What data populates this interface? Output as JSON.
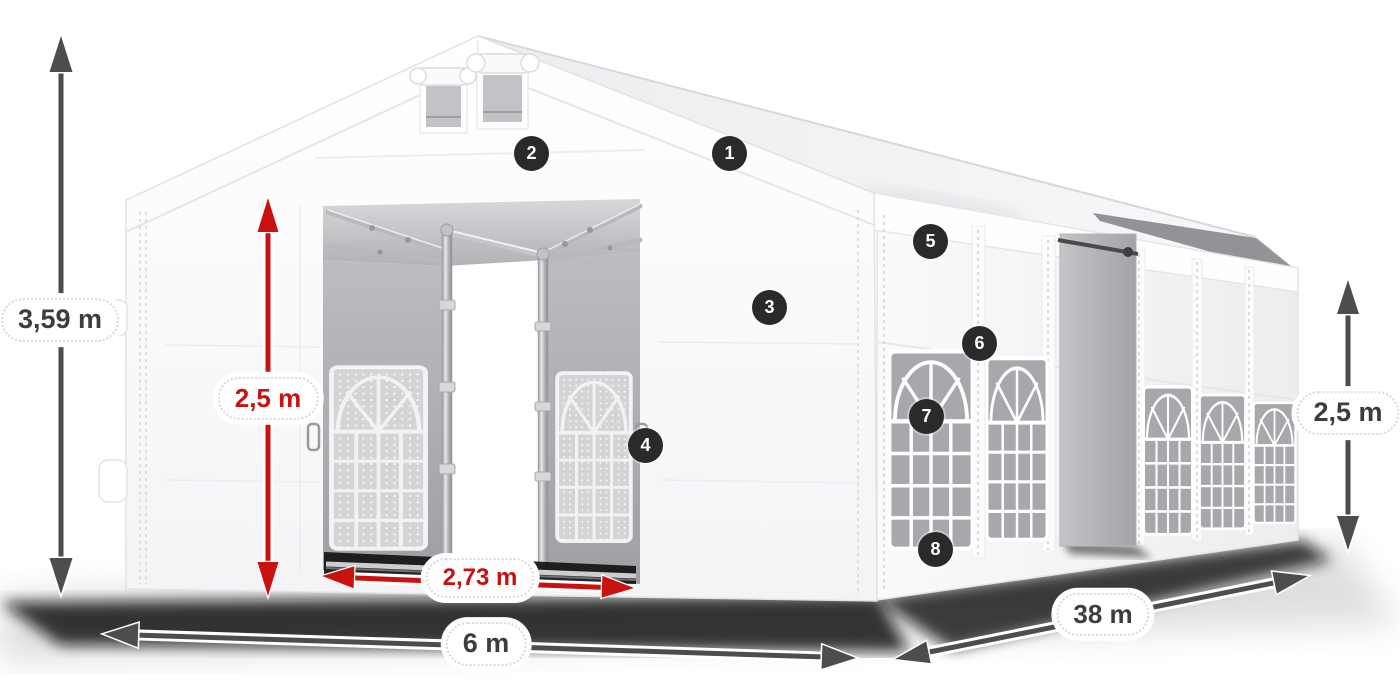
{
  "page": {
    "background": "#ffffff",
    "description": "3D product dimension diagram of a white gabled storage/party tent shown in perspective, with measurement arrows and eight numbered feature markers"
  },
  "colors": {
    "dimension_arrow_dark": "#4d4d4f",
    "dimension_arrow_red": "#c9120f",
    "label_text_dark": "#3d3d3f",
    "label_text_red": "#c9110f",
    "label_pill_bg": "#ffffff",
    "marker_bg": "#2a2a2c",
    "marker_text": "#ffffff",
    "tent_white": "#fdfdfe",
    "interior_gray": "#b0b0b4",
    "window_glass_gray": "#a8a8ac",
    "ground_shadow": "#0d0d0e"
  },
  "dimensions": {
    "total_height": {
      "label": "3,59 m",
      "style": "dark",
      "orientation": "vertical",
      "location": "left-of-tent"
    },
    "door_height": {
      "label": "2,5 m",
      "style": "red",
      "orientation": "vertical",
      "location": "front-door"
    },
    "door_width": {
      "label": "2,73 m",
      "style": "red",
      "orientation": "horizontal",
      "location": "front-door-base"
    },
    "width": {
      "label": "6 m",
      "style": "dark",
      "orientation": "horizontal",
      "location": "front-base"
    },
    "length": {
      "label": "38 m",
      "style": "dark",
      "orientation": "diagonal",
      "location": "side-base"
    },
    "side_wall_height": {
      "label": "2,5 m",
      "style": "dark",
      "orientation": "vertical",
      "location": "right-of-tent"
    }
  },
  "markers": [
    {
      "number": "1"
    },
    {
      "number": "2"
    },
    {
      "number": "3"
    },
    {
      "number": "4"
    },
    {
      "number": "5"
    },
    {
      "number": "6"
    },
    {
      "number": "7"
    },
    {
      "number": "8"
    }
  ]
}
